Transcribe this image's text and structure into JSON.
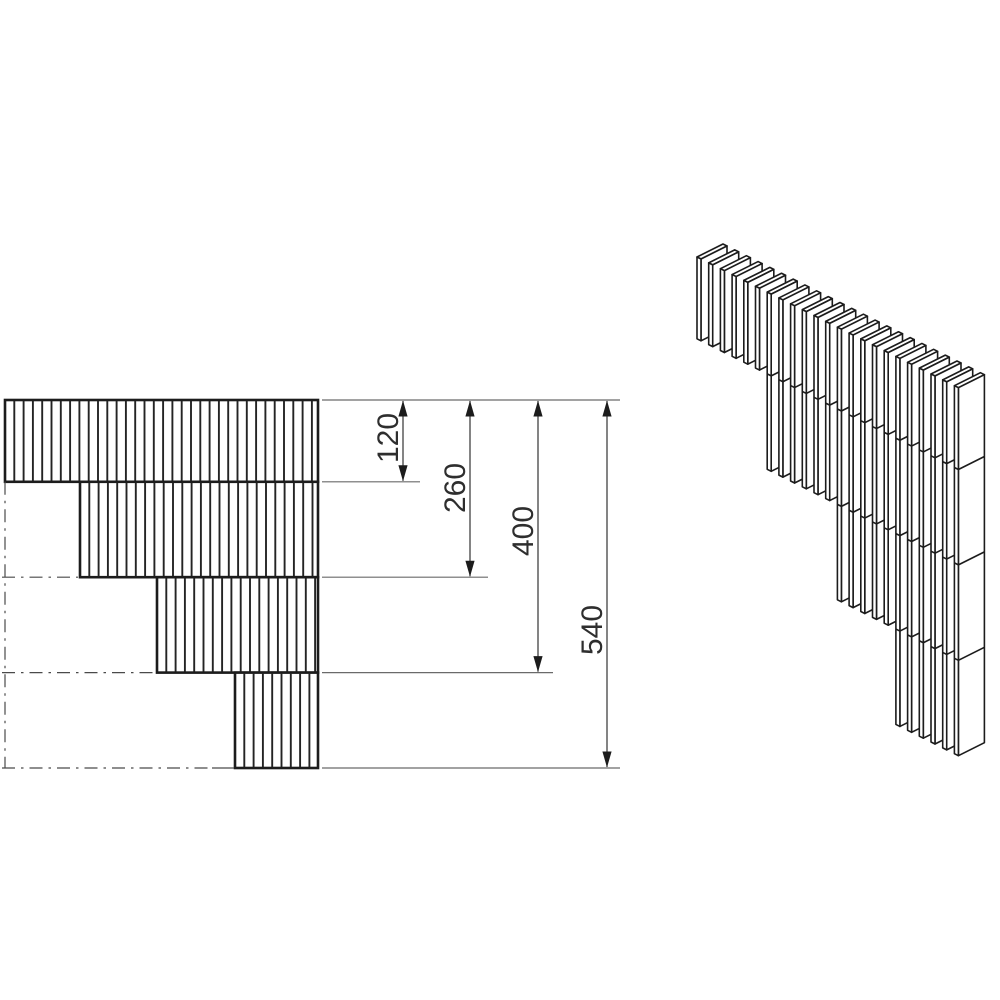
{
  "page": {
    "background": "#ffffff",
    "kind": "technical-dimension-drawing"
  },
  "drawing": {
    "colors": {
      "heavy_line": "#1c1c1c",
      "hatch_line": "#242424",
      "thin_line": "#4a4a4a",
      "ext_line": "#6a6a6a",
      "text": "#2e2e2e",
      "fill": "#ffffff"
    },
    "stroke_widths": {
      "heavy": 2.6,
      "hatch": 1.9,
      "iso": 1.6,
      "thin": 1.2
    },
    "front_view": {
      "unit_scale": 0.6815,
      "y_top": 400,
      "x_right": 318,
      "hatch_pitch": 9.3,
      "bands": [
        {
          "depth_start": 0,
          "depth_end": 120,
          "x_start": 5
        },
        {
          "depth_start": 120,
          "depth_end": 260,
          "x_start": 80
        },
        {
          "depth_start": 260,
          "depth_end": 400,
          "x_start": 157
        },
        {
          "depth_start": 400,
          "depth_end": 540,
          "x_start": 235
        }
      ],
      "centerlines": [
        {
          "x1": 5,
          "y1": 481.8,
          "x2": 5,
          "y2": 768,
          "dash": true
        },
        {
          "x1": 2,
          "y1": 577.2,
          "x2": 78,
          "y2": 577.2,
          "dash": true
        },
        {
          "x1": 2,
          "y1": 672.6,
          "x2": 155,
          "y2": 672.6,
          "dash": true
        },
        {
          "x1": 2,
          "y1": 768,
          "x2": 212,
          "y2": 768,
          "dash": true
        },
        {
          "x1": 212,
          "y1": 768,
          "x2": 234,
          "y2": 768,
          "dash": false
        }
      ]
    },
    "dimensions": {
      "ext_start_x": 322,
      "top_ext": {
        "y": 400,
        "x1": 322,
        "x2": 620
      },
      "arrow": {
        "half_width": 4.6,
        "length": 16
      },
      "items": [
        {
          "label": "120",
          "value": 120,
          "line_x": 403,
          "y_end": 481.8,
          "ext_end_x": 420,
          "label_x": 398,
          "label_y": 438
        },
        {
          "label": "260",
          "value": 260,
          "line_x": 470,
          "y_end": 577.2,
          "ext_end_x": 488,
          "label_x": 465,
          "label_y": 488
        },
        {
          "label": "400",
          "value": 400,
          "line_x": 538,
          "y_end": 672.6,
          "ext_end_x": 553,
          "label_x": 533,
          "label_y": 531
        },
        {
          "label": "540",
          "value": 540,
          "line_x": 607,
          "y_end": 768,
          "ext_end_x": 620,
          "label_x": 602,
          "label_y": 630
        }
      ]
    },
    "iso_view": {
      "origin_x": 697,
      "origin_y": 257,
      "pitch_x": 11.7,
      "pitch_y": 5.85,
      "thickness": [
        4,
        2
      ],
      "depth_vec": [
        26,
        -13
      ],
      "unit_scale": 0.6815,
      "groups": [
        {
          "count": 6,
          "depth_units": 120
        },
        {
          "count": 6,
          "depth_units": 260
        },
        {
          "count": 5,
          "depth_units": 400
        },
        {
          "count": 6,
          "depth_units": 540
        }
      ],
      "joint_depths_units": [
        120,
        260,
        400
      ]
    }
  }
}
